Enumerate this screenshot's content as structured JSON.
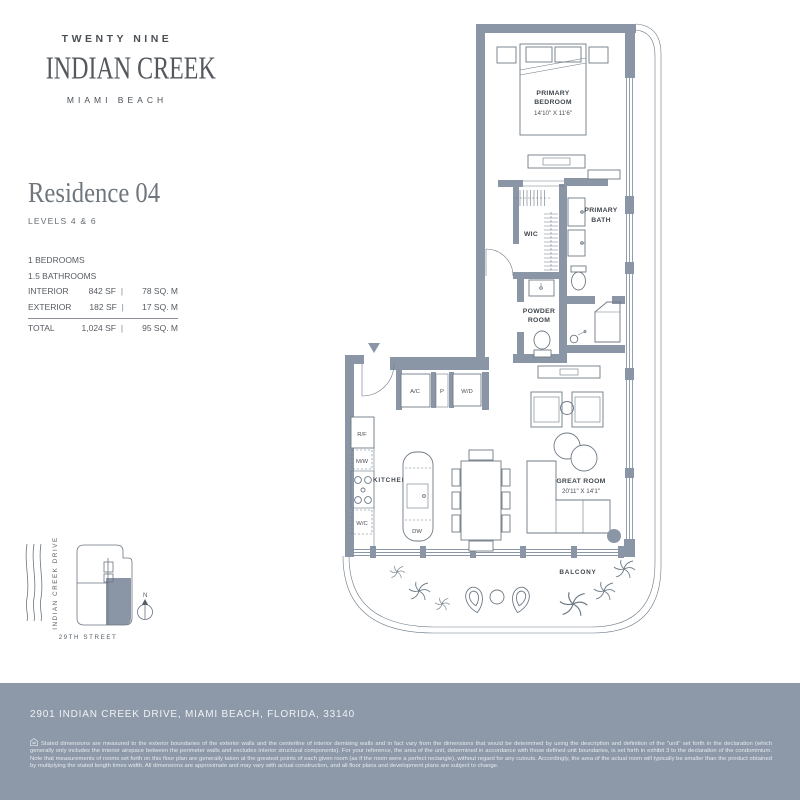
{
  "brand": {
    "line1": "TWENTY NINE",
    "line2": "INDIAN CREEK",
    "line3": "MIAMI BEACH"
  },
  "residence": {
    "title": "Residence 04",
    "levels": "LEVELS 4 & 6",
    "bedrooms": "1 BEDROOMS",
    "bathrooms": "1.5 BATHROOMS",
    "divider": "|",
    "rows": [
      {
        "label": "INTERIOR",
        "sf": "842 SF",
        "sqm": "78 SQ. M"
      },
      {
        "label": "EXTERIOR",
        "sf": "182 SF",
        "sqm": "17 SQ. M"
      },
      {
        "label": "TOTAL",
        "sf": "1,024 SF",
        "sqm": "95 SQ. M"
      }
    ]
  },
  "plan": {
    "labels": {
      "bedroom_1": "PRIMARY",
      "bedroom_2": "BEDROOM",
      "bedroom_dims": "14'10\" X 11'6\"",
      "wic": "WIC",
      "bath_1": "PRIMARY",
      "bath_2": "BATH",
      "powder_1": "POWDER",
      "powder_2": "ROOM",
      "kitchen": "KITCHEN",
      "great_room": "GREAT ROOM",
      "great_room_dims": "20'11\" X 14'1\"",
      "balcony": "BALCONY"
    },
    "fixtures": {
      "ac": "A/C",
      "pantry": "P",
      "washer_dryer": "W/D",
      "fridge": "R/F",
      "microwave": "M/W",
      "wine_cooler": "W/C",
      "dishwasher": "DW"
    }
  },
  "sitemap": {
    "drive": "INDIAN CREEK DRIVE",
    "street": "29TH STREET",
    "north": "N"
  },
  "footer": {
    "address": "2901 INDIAN CREEK DRIVE, MIAMI BEACH, FLORIDA, 33140",
    "disclaimer": "Stated dimensions are measured to the exterior boundaries of the exterior walls and the centerline of interior demising walls and in fact vary from the dimensions that would be determined by using the description and definition of the \"unit\" set forth in the declaration (which generally only includes the interior airspace between the perimeter walls and excludes interior structural components). For your reference, the area of the unit, determined in accordance with those defined unit boundaries, is set forth in exhibit 3 to the declaration of the condominium. Note that measurements of rooms set forth on this floor plan are generally taken at the greatest points of each given room (as if the room were a perfect rectangle), without regard for any cutouts. Accordingly, the area of the actual room will typically be smaller than the product obtained by multiplying the stated length times width. All dimensions are approximate and may vary with actual construction, and all floor plans and development plans are subject to change."
  },
  "colors": {
    "wall": "#8A96A5",
    "footer": "#8D99A8",
    "linework": "#6E7A86"
  }
}
